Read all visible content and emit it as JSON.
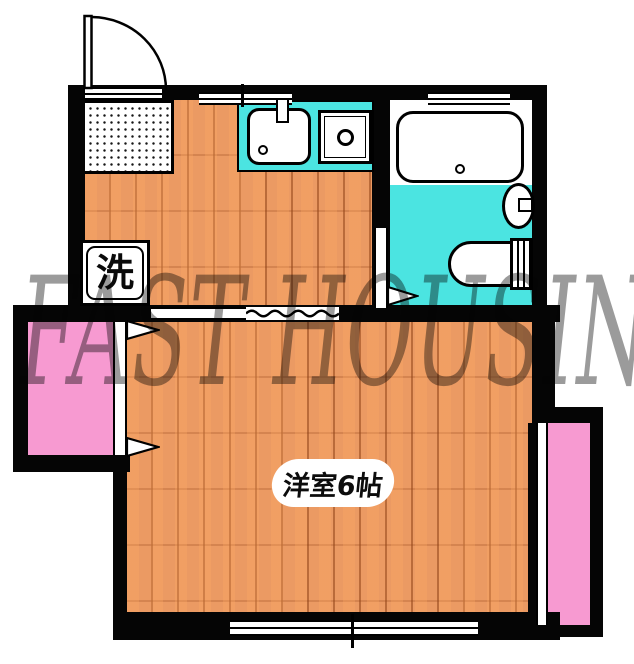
{
  "watermark": {
    "text": "FAST HOUSING",
    "color": "#8a8a8a"
  },
  "labels": {
    "main_room": "洋室6帖",
    "washer": "洗"
  },
  "colors": {
    "wall": "#050505",
    "wood_floor": "#eb9a63",
    "wood_plank_line": "#92441a",
    "bathroom_floor": "#4be4e1",
    "kitchen_counter": "#4be4e1",
    "closet_pink": "#f79ad1",
    "balcony_pink": "#f79ad1",
    "watermark_gray": "#525252"
  }
}
